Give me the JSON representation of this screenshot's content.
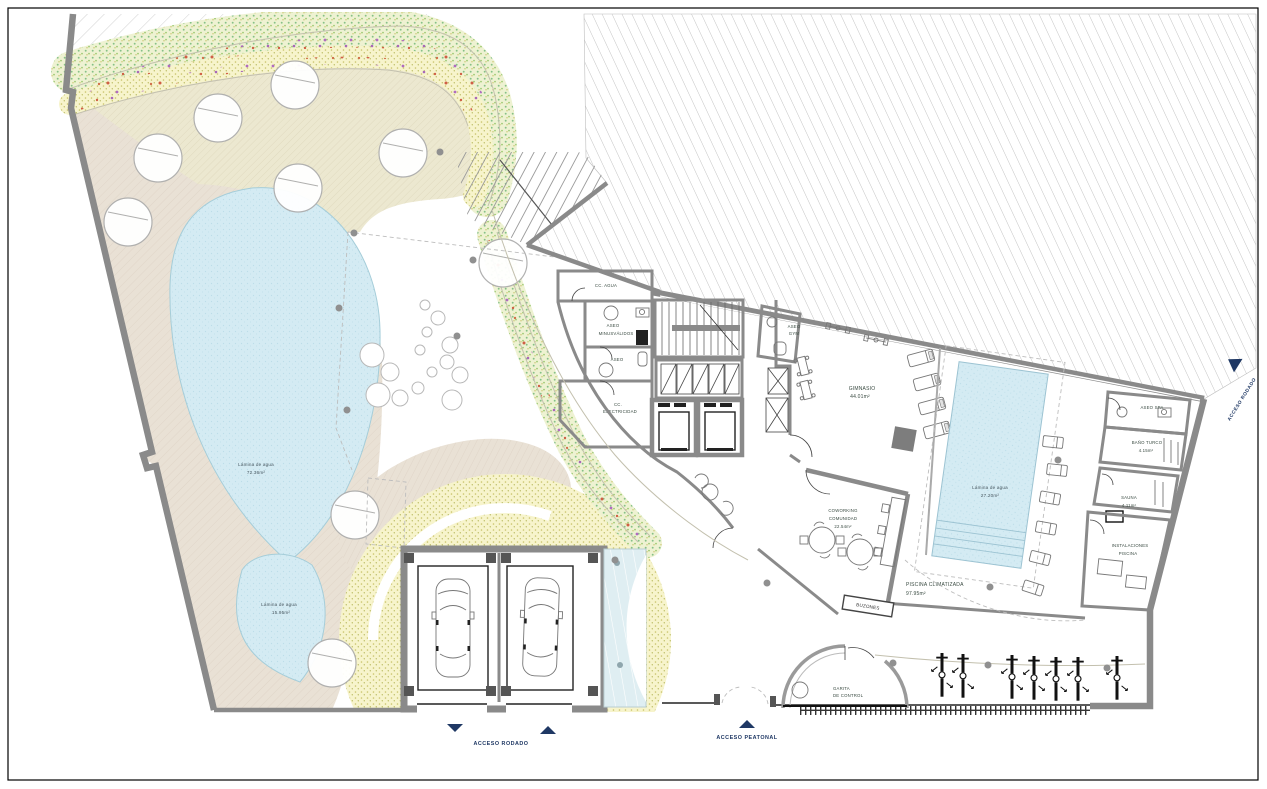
{
  "colors": {
    "accent_navy": "#1f3864",
    "wall_gray": "#8a8a8a",
    "water_blue": "#cfe9f3",
    "room_label": "#3a4b42"
  },
  "labels": {
    "cc_agua": "CC. AGUA",
    "aseo_minusvalidos_line1": "ASEO",
    "aseo_minusvalidos_line2": "MINUSVÁLIDOS",
    "aseo": "ASEO",
    "cc_electricidad_line1": "CC.",
    "cc_electricidad_line2": "ELECTRICIDAD",
    "aseo_gym_line1": "ASEO",
    "aseo_gym_line2": "GYM",
    "gimnasio": "GIMNASIO",
    "gimnasio_area": "44.01m²",
    "coworking_line1": "COWORKING",
    "coworking_line2": "COMUNIDAD",
    "coworking_area": "22.54m²",
    "lamina_interior": "Lámina de agua",
    "lamina_interior_area": "27.20m²",
    "piscina": "PISCINA CLIMATIZADA",
    "piscina_area": "97.95m²",
    "aseo_spa": "ASEO SPA",
    "bano_turco": "BAÑO TURCO",
    "bano_turco_area": "4.15m²",
    "sauna": "SAUNA",
    "sauna_area": "4.11m²",
    "instalaciones_line1": "INSTALACIONES",
    "instalaciones_line2": "PISCINA",
    "garita_line1": "GARITA",
    "garita_line2": "DE CONTROL",
    "buzones": "BUZONES",
    "lamina_grande": "Lámina de agua",
    "lamina_grande_area": "72.36m²",
    "lamina_peq": "Lámina de agua",
    "lamina_peq_area": "15.95m²",
    "acceso_rodado": "ACCESO RODADO",
    "acceso_peatonal": "ACCESO PEATONAL",
    "acceso_rodado_lateral": "ACCESO RODADO"
  }
}
